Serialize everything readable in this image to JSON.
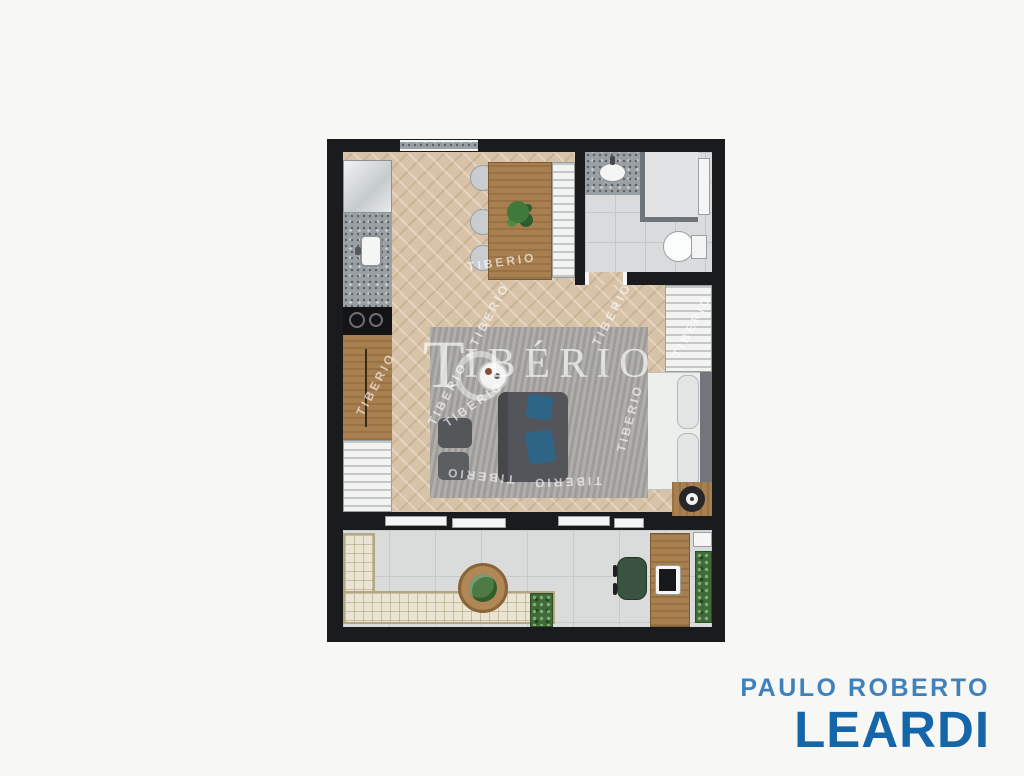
{
  "page": {
    "background_color": "#f7f7f6"
  },
  "floor_plan": {
    "wall_color": "#1a1b1d",
    "wood_floor_color": "#d8c3a8",
    "tile_floor_color": "#d9dbdc",
    "rug_color": "#a7a6a2",
    "bed_blanket_color": "#41704e",
    "sofa_color": "#53555a",
    "cushion_color": "#2e6587",
    "plant_color": "#3f6b38",
    "bench_color": "#eae4d2",
    "wood_furniture_color": "#a8804f"
  },
  "watermark": {
    "brand_initial": "T",
    "brand_rest": "IBÉRIO",
    "tile_text": "TIBERIO",
    "tile_text_pair": "TIBERIO • TIBERIO"
  },
  "logo": {
    "line1": "PAULO ROBERTO",
    "line2": "LEARDI",
    "line1_color": "#3f82bb",
    "line2_color": "#1565a9"
  }
}
